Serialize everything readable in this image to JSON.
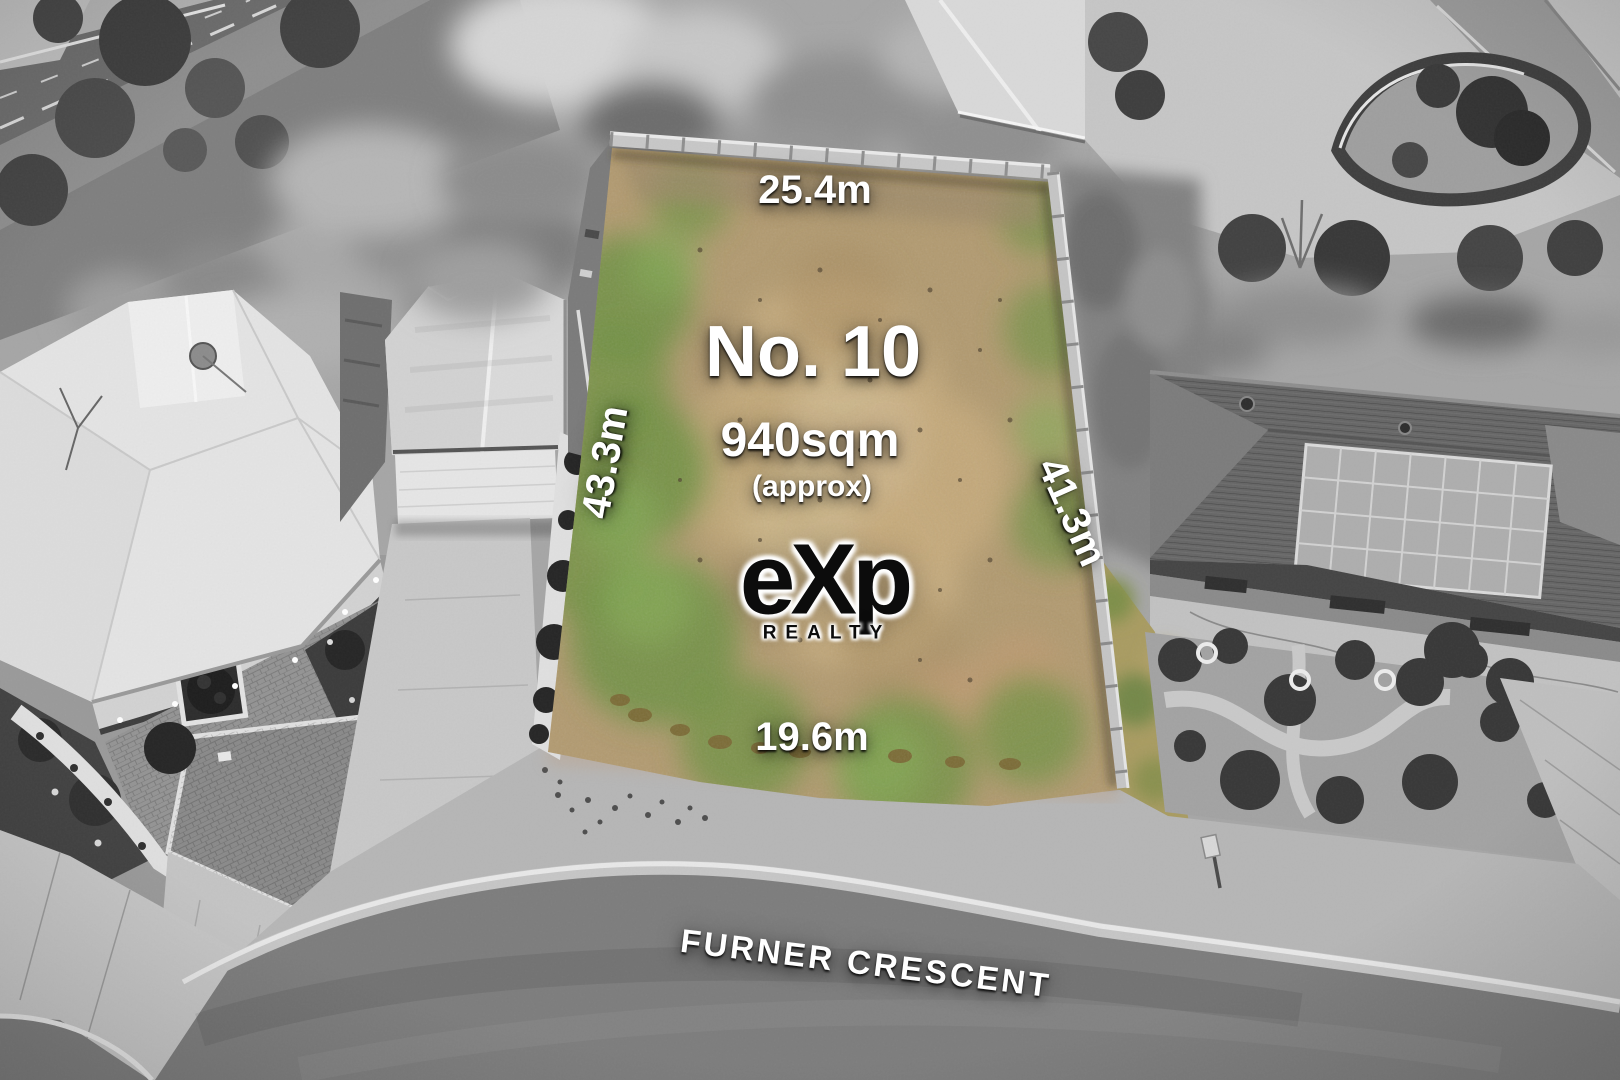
{
  "photo": {
    "type": "aerial-drone-photo",
    "street_name": "FURNER CRESCENT"
  },
  "lot": {
    "number_label": "No. 10",
    "area": "940sqm",
    "area_qualifier": "(approx)",
    "dimensions": {
      "rear": "25.4m",
      "left": "43.3m",
      "right": "41.3m",
      "front": "19.6m"
    }
  },
  "brand": {
    "name": "eXp",
    "tagline": "REALTY"
  },
  "colors": {
    "lot_grass_green": "#6f9142",
    "lot_grass_dry": "#c1a87a",
    "surroundings": "grayscale",
    "label_text": "#ffffff",
    "logo_text": "#0d0d0d"
  }
}
